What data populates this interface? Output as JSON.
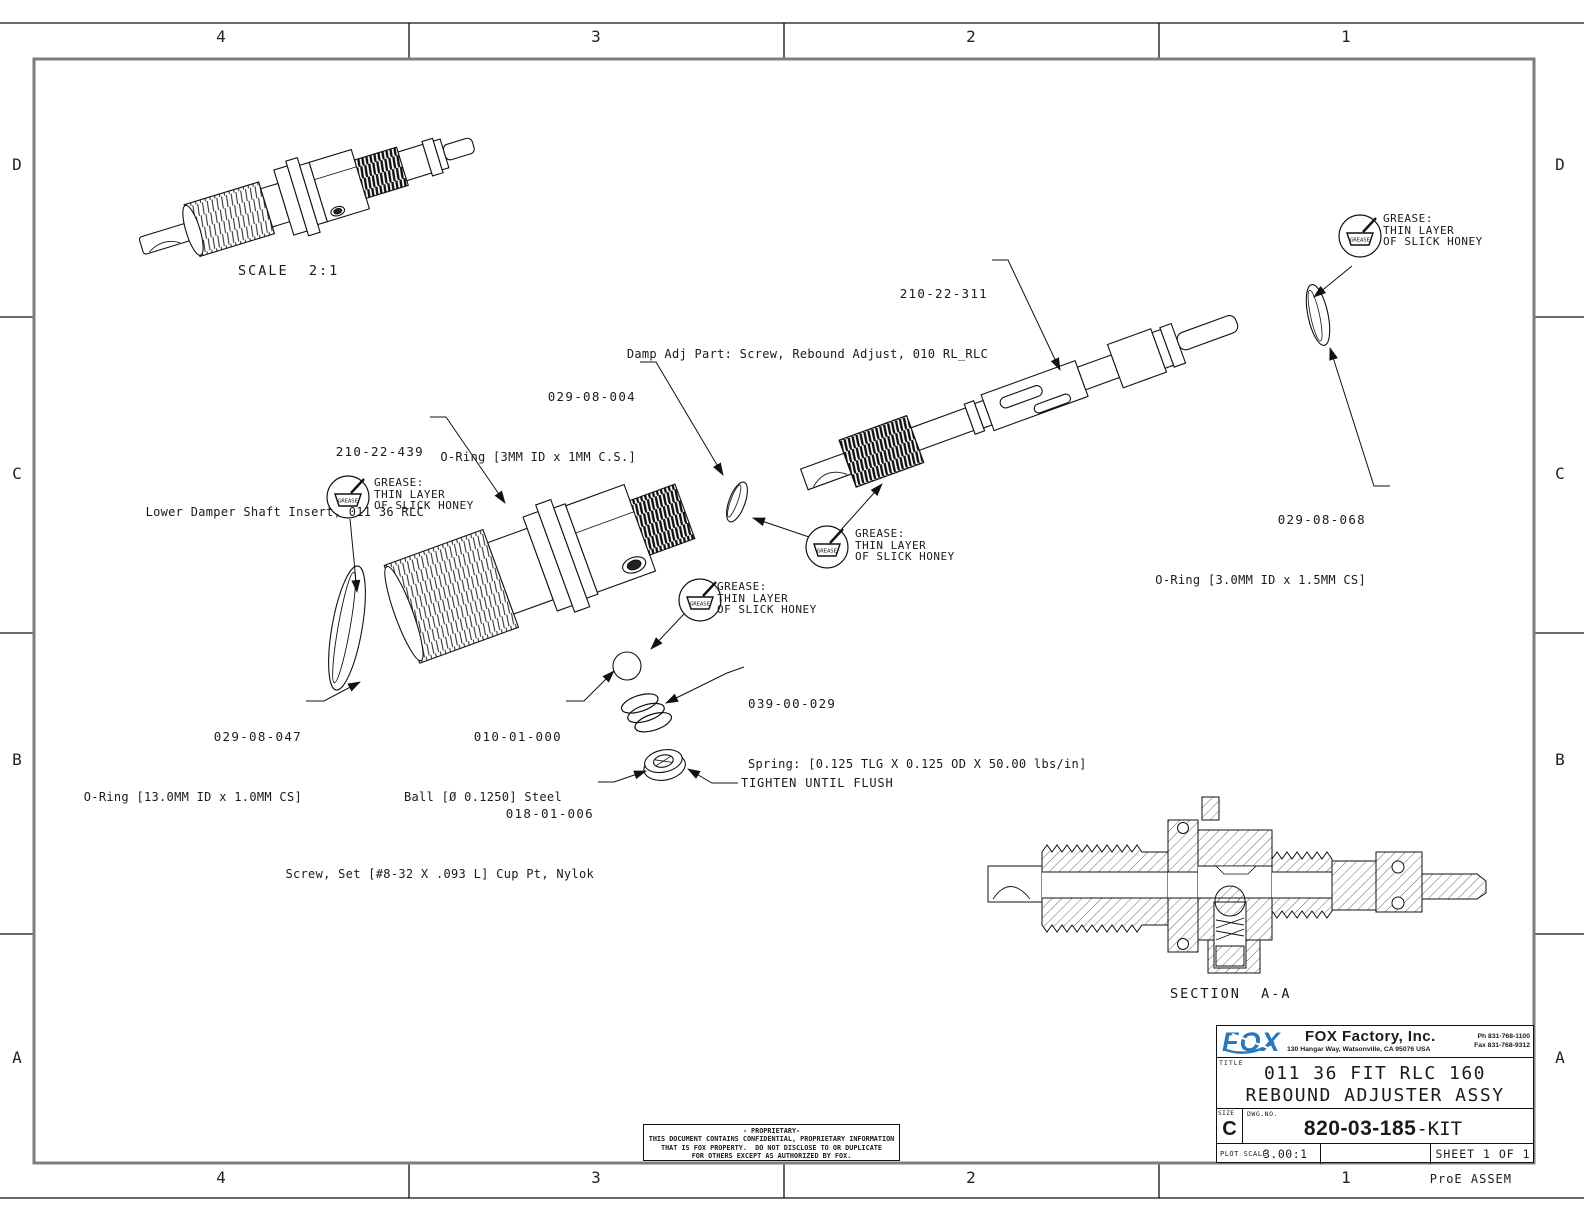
{
  "sheet": {
    "zones_top": [
      "4",
      "3",
      "2",
      "1"
    ],
    "zones_bottom": [
      "4",
      "3",
      "2",
      "1"
    ],
    "zones_left": [
      "D",
      "C",
      "B",
      "A"
    ],
    "zones_right": [
      "D",
      "C",
      "B",
      "A"
    ],
    "footer_note": "ProE ASSEM"
  },
  "views": {
    "scale_label": "SCALE  2:1",
    "section_label": "SECTION  A-A"
  },
  "callouts": {
    "damp_adj": {
      "part_no": "210-22-311",
      "desc": "Damp Adj Part: Screw, Rebound Adjust, 010 RL_RLC"
    },
    "oring_small": {
      "part_no": "029-08-004",
      "desc": "O-Ring [3MM ID x 1MM C.S.]"
    },
    "shaft_insert": {
      "part_no": "210-22-439",
      "desc": "Lower Damper Shaft Insert, 011 36 RLC"
    },
    "oring_right": {
      "part_no": "029-08-068",
      "desc": "O-Ring [3.0MM ID x 1.5MM CS]"
    },
    "oring_large": {
      "part_no": "029-08-047",
      "desc": "O-Ring [13.0MM ID x 1.0MM CS]"
    },
    "ball": {
      "part_no": "010-01-000",
      "desc": "Ball [Ø 0.1250] Steel"
    },
    "spring": {
      "part_no": "039-00-029",
      "desc": "Spring: [0.125 TLG X 0.125 OD X 50.00 lbs/in]"
    },
    "set_screw": {
      "part_no": "018-01-006",
      "desc": "Screw, Set [#8-32 X .093 L] Cup Pt, Nylok"
    }
  },
  "notes": {
    "tighten": "TIGHTEN UNTIL FLUSH",
    "grease_icon_label": "GREASE",
    "grease_line1": "GREASE:",
    "grease_line2": "THIN LAYER",
    "grease_line3": "OF SLICK HONEY"
  },
  "title_block": {
    "logo_text": "FOX",
    "logo_color": "#2878be",
    "company": "FOX Factory, Inc.",
    "address": "130 Hangar Way, Watsonville, CA 95076 USA",
    "phone": "Ph 831-768-1100",
    "fax": "Fax 831-768-9312",
    "title_label": "TITLE",
    "title_line1": "011 36 FIT RLC 160",
    "title_line2": "REBOUND ADJUSTER ASSY",
    "size_label": "SIZE",
    "size": "C",
    "dwg_label": "DWG.NO.",
    "dwg_no_bold": "820-03-185",
    "dwg_no_suffix": "-KIT",
    "plot_scale_label": "PLOT SCALE",
    "plot_scale": "3.00:1",
    "sheet": "SHEET 1 OF 1"
  },
  "proprietary": {
    "line1": "- PROPRIETARY-",
    "line2": "THIS DOCUMENT CONTAINS CONFIDENTIAL, PROPRIETARY INFORMATION",
    "line3": "THAT IS FOX PROPERTY.  DO NOT DISCLOSE TO OR DUPLICATE",
    "line4": "FOR OTHERS EXCEPT AS AUTHORIZED BY FOX."
  }
}
